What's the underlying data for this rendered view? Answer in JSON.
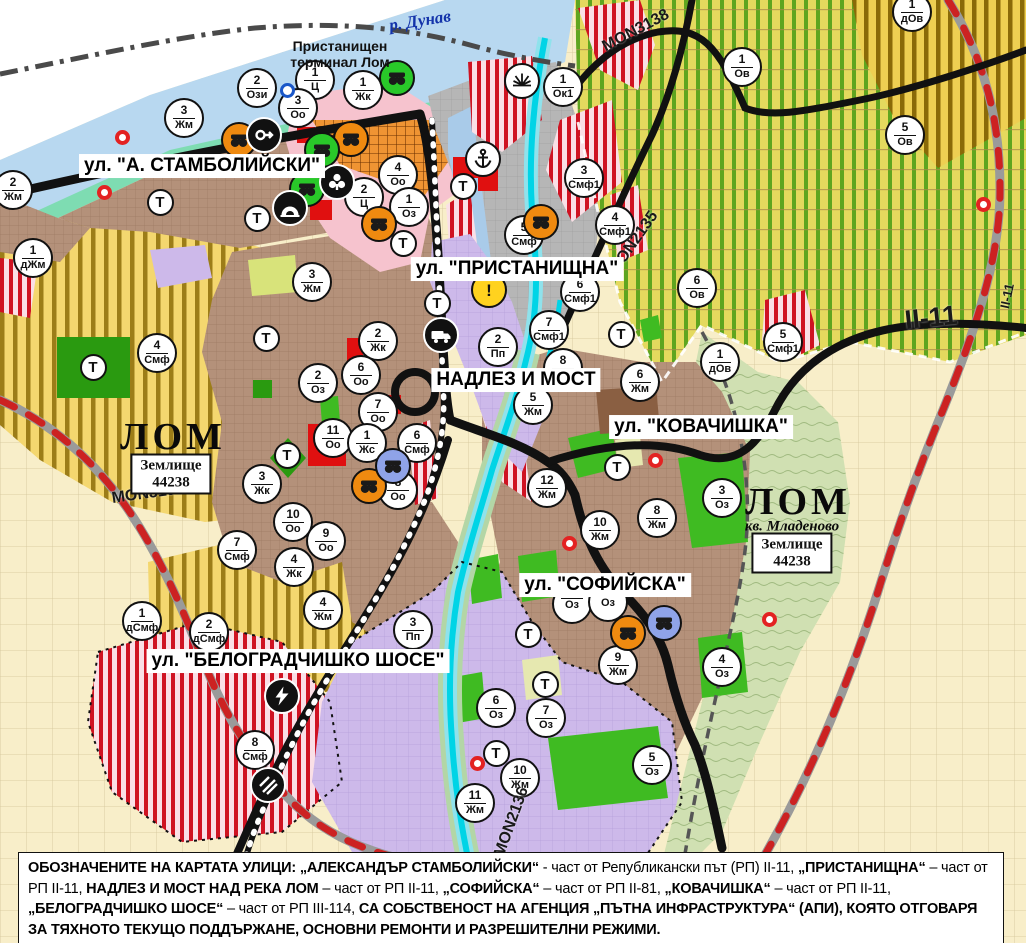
{
  "map": {
    "street_labels": [
      {
        "text": "ул. \"А. СТАМБОЛИЙСКИ\"",
        "x": 202,
        "y": 166
      },
      {
        "text": "ул. \"ПРИСТАНИЩНА\"",
        "x": 517,
        "y": 269
      },
      {
        "text": "НАДЛЕЗ И МОСТ",
        "x": 516,
        "y": 380
      },
      {
        "text": "ул. \"КОВАЧИШКА\"",
        "x": 701,
        "y": 427
      },
      {
        "text": "ул. \"СОФИЙСКА\"",
        "x": 605,
        "y": 585
      },
      {
        "text": "ул. \"БЕЛОГРАДЧИШКО ШОСЕ\"",
        "x": 298,
        "y": 661
      }
    ],
    "road_labels": [
      {
        "text": "MON3138",
        "x": 636,
        "y": 31,
        "rot": -28,
        "fs": 16
      },
      {
        "text": "MON2135",
        "x": 634,
        "y": 243,
        "rot": -55,
        "fs": 16
      },
      {
        "text": "MON3139",
        "x": 148,
        "y": 494,
        "rot": -8,
        "fs": 16
      },
      {
        "text": "MON2136",
        "x": 512,
        "y": 822,
        "rot": -70,
        "fs": 16
      },
      {
        "text": "II-11",
        "x": 931,
        "y": 318,
        "rot": -6,
        "fs": 27
      },
      {
        "text": "II-11",
        "x": 1007,
        "y": 296,
        "rot": -78,
        "fs": 13
      }
    ],
    "place_labels": [
      {
        "text": "ЛОМ",
        "x": 173,
        "y": 437,
        "style": "city"
      },
      {
        "text": "ЛОМ",
        "x": 798,
        "y": 502,
        "style": "city"
      },
      {
        "text": "кв. Младеново",
        "x": 792,
        "y": 527,
        "style": "quarter"
      },
      {
        "text": "р. Дунав",
        "x": 420,
        "y": 21,
        "style": "river"
      },
      {
        "text": "Пристанищен терминал Лом",
        "x": 340,
        "y": 54,
        "style": "terminal"
      }
    ],
    "area_boxes": [
      {
        "line1": "Землище",
        "line2": "44238",
        "x": 171,
        "y": 474
      },
      {
        "line1": "Землище",
        "line2": "44238",
        "x": 792,
        "y": 553
      }
    ],
    "t_label": "Т",
    "t_markers": [
      {
        "x": 160,
        "y": 202
      },
      {
        "x": 257,
        "y": 218
      },
      {
        "x": 266,
        "y": 338
      },
      {
        "x": 93,
        "y": 367
      },
      {
        "x": 287,
        "y": 455
      },
      {
        "x": 403,
        "y": 243
      },
      {
        "x": 437,
        "y": 303
      },
      {
        "x": 463,
        "y": 186
      },
      {
        "x": 621,
        "y": 334
      },
      {
        "x": 617,
        "y": 467
      },
      {
        "x": 528,
        "y": 634
      },
      {
        "x": 545,
        "y": 684
      },
      {
        "x": 496,
        "y": 753
      }
    ],
    "zone_markers": [
      {
        "num": "3",
        "code": "Жм",
        "x": 184,
        "y": 118
      },
      {
        "num": "2",
        "code": "Ози",
        "x": 257,
        "y": 88
      },
      {
        "num": "1",
        "code": "Ц",
        "x": 315,
        "y": 80
      },
      {
        "num": "3",
        "code": "Оо",
        "x": 298,
        "y": 108
      },
      {
        "num": "1",
        "code": "Жк",
        "x": 363,
        "y": 90
      },
      {
        "num": "1",
        "code": "Ок1",
        "x": 563,
        "y": 87
      },
      {
        "num": "2",
        "code": "Жм",
        "x": 13,
        "y": 190
      },
      {
        "num": "1",
        "code": "дЖм",
        "x": 33,
        "y": 258
      },
      {
        "num": "4",
        "code": "Смф",
        "x": 157,
        "y": 353
      },
      {
        "num": "4",
        "code": "Оо",
        "x": 398,
        "y": 175
      },
      {
        "num": "2",
        "code": "Ц",
        "x": 364,
        "y": 197
      },
      {
        "num": "1",
        "code": "Оз",
        "x": 409,
        "y": 207
      },
      {
        "num": "3",
        "code": "Жм",
        "x": 312,
        "y": 282
      },
      {
        "num": "5",
        "code": "Смф",
        "x": 524,
        "y": 235
      },
      {
        "num": "6",
        "code": "Смф1",
        "x": 580,
        "y": 292
      },
      {
        "num": "7",
        "code": "Смф1",
        "x": 549,
        "y": 330
      },
      {
        "num": "3",
        "code": "Смф1",
        "x": 584,
        "y": 178
      },
      {
        "num": "4",
        "code": "Смф1",
        "x": 615,
        "y": 225
      },
      {
        "num": "1",
        "code": "Ов",
        "x": 742,
        "y": 67
      },
      {
        "num": "1",
        "code": "дОв",
        "x": 912,
        "y": 12
      },
      {
        "num": "5",
        "code": "Ов",
        "x": 905,
        "y": 135
      },
      {
        "num": "6",
        "code": "Ов",
        "x": 697,
        "y": 288
      },
      {
        "num": "1",
        "code": "дОв",
        "x": 720,
        "y": 362
      },
      {
        "num": "5",
        "code": "Смф1",
        "x": 783,
        "y": 342
      },
      {
        "num": "2",
        "code": "Пп",
        "x": 498,
        "y": 347
      },
      {
        "num": "8",
        "code": "Жм",
        "x": 563,
        "y": 368
      },
      {
        "num": "5",
        "code": "Жм",
        "x": 533,
        "y": 405
      },
      {
        "num": "6",
        "code": "Жм",
        "x": 640,
        "y": 382
      },
      {
        "num": "2",
        "code": "Жк",
        "x": 378,
        "y": 341
      },
      {
        "num": "2",
        "code": "Оз",
        "x": 318,
        "y": 383
      },
      {
        "num": "6",
        "code": "Оо",
        "x": 361,
        "y": 375
      },
      {
        "num": "7",
        "code": "Оо",
        "x": 378,
        "y": 412
      },
      {
        "num": "11",
        "code": "Оо",
        "x": 333,
        "y": 438
      },
      {
        "num": "1",
        "code": "Жс",
        "x": 367,
        "y": 443
      },
      {
        "num": "6",
        "code": "Смф",
        "x": 417,
        "y": 443
      },
      {
        "num": "8",
        "code": "Оо",
        "x": 398,
        "y": 490
      },
      {
        "num": "3",
        "code": "Жк",
        "x": 262,
        "y": 484
      },
      {
        "num": "10",
        "code": "Оо",
        "x": 293,
        "y": 522
      },
      {
        "num": "9",
        "code": "Оо",
        "x": 326,
        "y": 541
      },
      {
        "num": "4",
        "code": "Жк",
        "x": 294,
        "y": 567
      },
      {
        "num": "7",
        "code": "Смф",
        "x": 237,
        "y": 550
      },
      {
        "num": "12",
        "code": "Жм",
        "x": 547,
        "y": 488
      },
      {
        "num": "10",
        "code": "Жм",
        "x": 600,
        "y": 530
      },
      {
        "num": "8",
        "code": "Жм",
        "x": 657,
        "y": 518
      },
      {
        "num": "3",
        "code": "Оз",
        "x": 722,
        "y": 498
      },
      {
        "num": "9",
        "code": "Жм",
        "x": 618,
        "y": 665
      },
      {
        "num": "4",
        "code": "Оз",
        "x": 722,
        "y": 667
      },
      {
        "num": "6",
        "code": "Оз",
        "x": 496,
        "y": 708
      },
      {
        "num": "7",
        "code": "Оз",
        "x": 546,
        "y": 718
      },
      {
        "num": "10",
        "code": "Жм",
        "x": 520,
        "y": 778
      },
      {
        "num": "11",
        "code": "Жм",
        "x": 475,
        "y": 803
      },
      {
        "num": "5",
        "code": "Оз",
        "x": 652,
        "y": 765
      },
      {
        "num": "4",
        "code": "Жм",
        "x": 323,
        "y": 610
      },
      {
        "num": "3",
        "code": "Пп",
        "x": 413,
        "y": 630
      },
      {
        "num": "2",
        "code": "дСмф",
        "x": 209,
        "y": 632
      },
      {
        "num": "8",
        "code": "Смф",
        "x": 255,
        "y": 750
      },
      {
        "num": "1",
        "code": "дСмф",
        "x": 142,
        "y": 621
      },
      {
        "num": "",
        "code": "Оз",
        "x": 572,
        "y": 604
      },
      {
        "num": "",
        "code": "Оз",
        "x": 608,
        "y": 602
      }
    ],
    "icon_markers": [
      {
        "icon": "masks",
        "bg": "#ef8a10",
        "x": 239,
        "y": 140
      },
      {
        "icon": "masks",
        "bg": "#ef8a10",
        "x": 351,
        "y": 139
      },
      {
        "icon": "masks",
        "bg": "#ef8a10",
        "x": 379,
        "y": 224
      },
      {
        "icon": "masks",
        "bg": "#ef8a10",
        "x": 541,
        "y": 222
      },
      {
        "icon": "masks",
        "bg": "#ef8a10",
        "x": 369,
        "y": 486
      },
      {
        "icon": "masks",
        "bg": "#ef8a10",
        "x": 628,
        "y": 633
      },
      {
        "icon": "masks",
        "bg": "#29c829",
        "x": 397,
        "y": 78
      },
      {
        "icon": "masks",
        "bg": "#29c829",
        "x": 322,
        "y": 150
      },
      {
        "icon": "masks",
        "bg": "#29c829",
        "x": 307,
        "y": 189
      },
      {
        "icon": "masks",
        "bg": "#8fa3e8",
        "x": 393,
        "y": 466
      },
      {
        "icon": "masks",
        "bg": "#8fa3e8",
        "x": 664,
        "y": 623
      },
      {
        "icon": "key-arrow",
        "bg": "#111111",
        "x": 264,
        "y": 135
      },
      {
        "icon": "trefoil",
        "bg": "#111111",
        "x": 337,
        "y": 182
      },
      {
        "icon": "tunnel",
        "bg": "#111111",
        "x": 290,
        "y": 208
      },
      {
        "icon": "anchor",
        "bg": "#ffffff",
        "x": 483,
        "y": 159
      },
      {
        "icon": "sun-fan",
        "bg": "#ffffff",
        "x": 522,
        "y": 81
      },
      {
        "icon": "warning",
        "bg": "#ffd21f",
        "x": 489,
        "y": 290
      },
      {
        "icon": "truck",
        "bg": "#111111",
        "x": 441,
        "y": 335
      },
      {
        "icon": "lightning",
        "bg": "#111111",
        "x": 282,
        "y": 696
      },
      {
        "icon": "rail-crossing",
        "bg": "#111111",
        "x": 268,
        "y": 785
      },
      {
        "icon": "blue-ring",
        "bg": "#ffffff",
        "x": 287,
        "y": 90
      }
    ],
    "point_markers": [
      {
        "x": 122,
        "y": 137
      },
      {
        "x": 104,
        "y": 192
      },
      {
        "x": 655,
        "y": 460
      },
      {
        "x": 569,
        "y": 543
      },
      {
        "x": 983,
        "y": 204
      },
      {
        "x": 477,
        "y": 763
      },
      {
        "x": 769,
        "y": 619
      }
    ]
  },
  "caption": {
    "segments": [
      {
        "t": "ОБОЗНАЧЕНИТЕ НА КАРТАТА УЛИЦИ: „АЛЕКСАНДЪР СТАМБОЛИЙСКИ“",
        "b": true
      },
      {
        "t": " - част от Републикански път (РП) II-11, ",
        "b": false
      },
      {
        "t": "„ПРИСТАНИЩНА“",
        "b": true
      },
      {
        "t": " – част от РП II-11, ",
        "b": false
      },
      {
        "t": "НАДЛЕЗ И МОСТ НАД РЕКА ЛОМ",
        "b": true
      },
      {
        "t": " – част от РП II-11, ",
        "b": false
      },
      {
        "t": "„СОФИЙСКА“",
        "b": true
      },
      {
        "t": " – част от РП II-81, ",
        "b": false
      },
      {
        "t": "„КОВАЧИШКА“",
        "b": true
      },
      {
        "t": " – част от РП II-11, ",
        "b": false
      },
      {
        "t": "„БЕЛОГРАДЧИШКО ШОСЕ“",
        "b": true
      },
      {
        "t": " – част от РП III-114, ",
        "b": false
      },
      {
        "t": "СА СОБСТВЕНОСТ НА АГЕНЦИЯ „ПЪТНА ИНФРАСТРУКТУРА“ (АПИ), КОЯТО ОТГОВАРЯ ЗА ТЯХНОТО ТЕКУЩО ПОДДЪРЖАНЕ, ОСНОВНИ РЕМОНТИ И РАЗРЕШИТЕЛНИ РЕЖИМИ.",
        "b": true
      }
    ]
  },
  "colors": {
    "danube": "#b8d8f0",
    "harbor": "#a9cbe9",
    "shore_green": "#7edcb2",
    "river_lom": "#00d4e6",
    "gold_zone": "#f4d76f",
    "orchard_zone": "#e4d95e",
    "smf_stripe": "#cf1322",
    "brown_city": "#b4917a",
    "lavender": "#cdb9ea",
    "park_green": "#3fbb22",
    "red_public": "#e01010",
    "road_black": "#111111",
    "rail_red": "#cc2222",
    "cream_fields": "#f8eec9"
  }
}
